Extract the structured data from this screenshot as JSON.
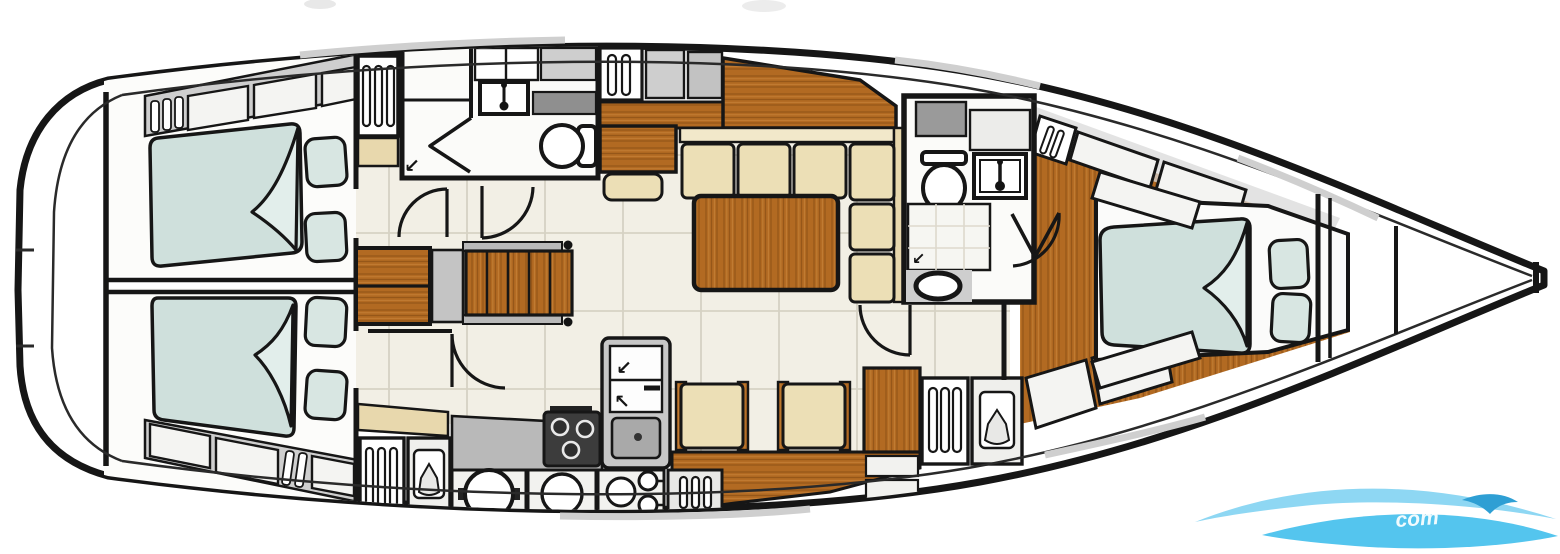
{
  "colors": {
    "wall": "#161616",
    "deck_line": "#2a2a2a",
    "wood": "#b26a22",
    "tile": "#f2efe5",
    "tile_line": "#d6d2c4",
    "mattress": "#cfe0dc",
    "mattress_fold": "#e2eeeb",
    "pillow": "#d8e6e2",
    "cushion": "#ecdfb6",
    "counter": "#b9b9b9",
    "locker": "#cecece",
    "locker_dark": "#9a9a9a",
    "stove": "#3c3c3c",
    "shelf_tan": "#e8d8ad",
    "toe_rail_gray": "#cfcfcf",
    "watermark_light": "#8ed7f3",
    "watermark_mid": "#54c5ee",
    "watermark_dark": "#2e9fd4"
  },
  "icons": {
    "drain": "↙",
    "fridge_arrow_upper": "↙",
    "fridge_arrow_lower": "↖"
  },
  "watermark": {
    "text": "com"
  },
  "fixtures": [
    "hull-outline",
    "swim-platform",
    "aft-cabin-port",
    "aft-cabin-starboard",
    "double-bed",
    "pillows",
    "shelf-lockers",
    "hanging-locker",
    "wet-locker",
    "aft-head",
    "shower",
    "sink",
    "toilet",
    "companionway-stairs",
    "engine-box",
    "chart-table",
    "chart-seat",
    "sideboard",
    "salon-settee",
    "salon-table",
    "salon-chairs",
    "galley-counter",
    "stove",
    "fridge",
    "galley-sinks",
    "forward-head",
    "washbasin-oval",
    "forward-cabin",
    "forward-berth",
    "bow-lockers",
    "watermark-logo"
  ]
}
